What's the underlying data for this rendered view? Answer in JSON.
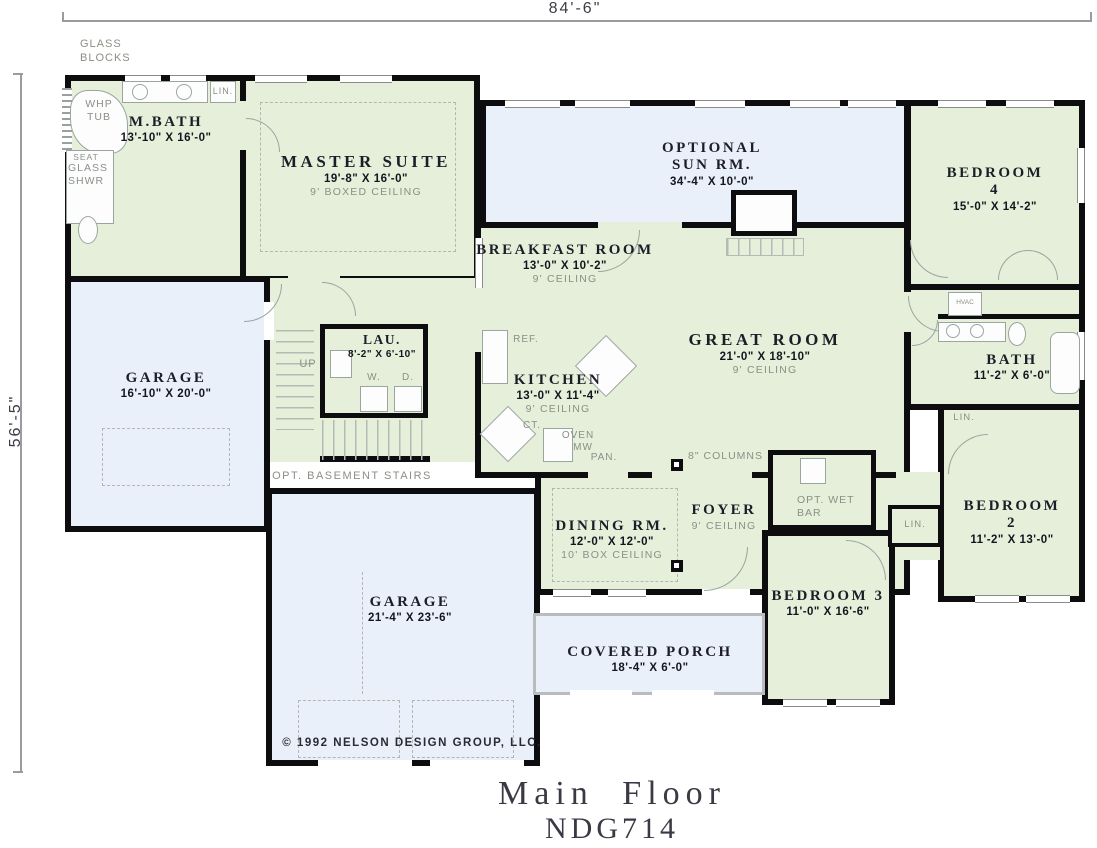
{
  "title": {
    "main": "Main Floor",
    "code": "NDG714"
  },
  "dimensions": {
    "width_label": "84'-6\"",
    "height_label": "56'-5\""
  },
  "copyright": "© 1992 NELSON DESIGN GROUP, LLC.",
  "colors": {
    "wall": "#0d0d0f",
    "room_green": "#e5efda",
    "room_blue": "#e9f0f9",
    "label_dark": "#1d1d28",
    "label_gray": "#8a9086",
    "fixture_gray": "#9aa5a0"
  },
  "rooms": [
    {
      "name": "M.BATH",
      "dims": "13'-10\" X 16'-0\""
    },
    {
      "name": "MASTER SUITE",
      "dims": "19'-8\" X 16'-0\"",
      "ceiling": "9' BOXED CEILING"
    },
    {
      "name": "OPTIONAL\nSUN RM.",
      "dims": "34'-4\" X 10'-0\""
    },
    {
      "name": "BEDROOM 4",
      "dims": "15'-0\" X 14'-2\""
    },
    {
      "name": "BREAKFAST ROOM",
      "dims": "13'-0\" X 10'-2\"",
      "ceiling": "9' CEILING"
    },
    {
      "name": "GREAT ROOM",
      "dims": "21'-0\" X 18'-10\"",
      "ceiling": "9' CEILING"
    },
    {
      "name": "GARAGE",
      "dims": "16'-10\" X 20'-0\""
    },
    {
      "name": "LAU.",
      "dims": "8'-2\" X 6'-10\""
    },
    {
      "name": "KITCHEN",
      "dims": "13'-0\" X 11'-4\"",
      "ceiling": "9' CEILING"
    },
    {
      "name": "BATH",
      "dims": "11'-2\" X 6'-0\""
    },
    {
      "name": "BEDROOM 2",
      "dims": "11'-2\" X 13'-0\""
    },
    {
      "name": "DINING RM.",
      "dims": "12'-0\" X 12'-0\"",
      "ceiling": "10' BOX CEILING"
    },
    {
      "name": "FOYER",
      "ceiling": "9' CEILING"
    },
    {
      "name": "BEDROOM 3",
      "dims": "11'-0\" X 16'-6\""
    },
    {
      "name": "GARAGE",
      "dims": "21'-4\" X 23'-6\""
    },
    {
      "name": "COVERED PORCH",
      "dims": "18'-4\" X 6'-0\""
    }
  ],
  "annotations": [
    {
      "id": "glass-blocks",
      "text": "GLASS\nBLOCKS"
    },
    {
      "id": "whirlpool-tub",
      "text": "WHP\nTUB"
    },
    {
      "id": "seat",
      "text": "SEAT"
    },
    {
      "id": "glass-shower",
      "text": "GLASS\nSHWR"
    },
    {
      "id": "linen-master",
      "text": "LIN."
    },
    {
      "id": "stairs-up",
      "text": "UP"
    },
    {
      "id": "washer",
      "text": "W."
    },
    {
      "id": "dryer",
      "text": "D."
    },
    {
      "id": "opt-basement-stairs",
      "text": "OPT. BASEMENT STAIRS"
    },
    {
      "id": "refrigerator",
      "text": "REF."
    },
    {
      "id": "cooktop",
      "text": "CT."
    },
    {
      "id": "oven",
      "text": "OVEN"
    },
    {
      "id": "microwave",
      "text": "MW"
    },
    {
      "id": "pantry",
      "text": "PAN."
    },
    {
      "id": "columns",
      "text": "8\" COLUMNS"
    },
    {
      "id": "opt-wet-bar",
      "text": "OPT. WET\nBAR"
    },
    {
      "id": "hvac",
      "text": "HVAC"
    },
    {
      "id": "linen-bath-hall",
      "text": "LIN."
    },
    {
      "id": "linen-bed-hall",
      "text": "LIN."
    }
  ]
}
